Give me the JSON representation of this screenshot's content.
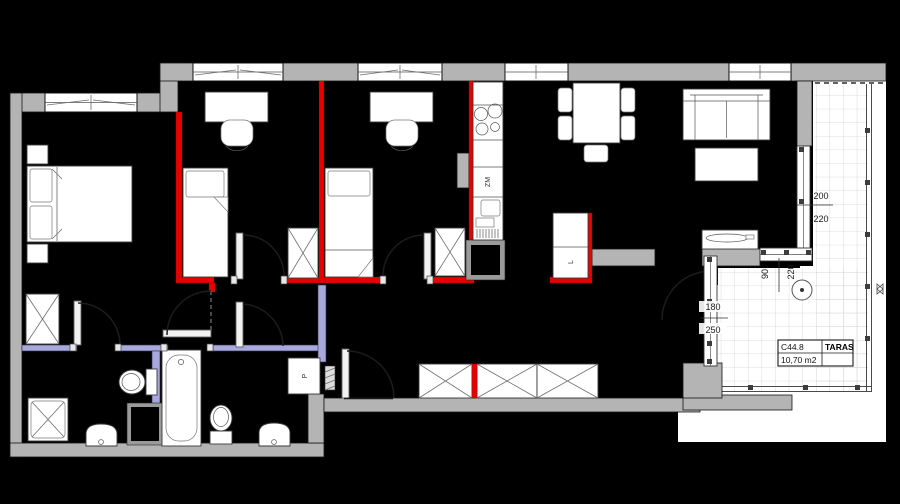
{
  "plan_type": "apartment-floor-plan",
  "colors": {
    "background": "#000000",
    "exterior_wall": "#b4b4b4",
    "partition_wall": "#e60000",
    "plumbing_wall": "#a8a8dc",
    "terrace_tile_line": "#d2d2d2",
    "outdoor": "#ffffff"
  },
  "labels": {
    "dishwasher": "ZM",
    "fridge": "L",
    "washing_machine": "P"
  },
  "terrace_card": {
    "code": "C44.8",
    "name": "TARAS",
    "area": "10,70 m2"
  },
  "dimensions": {
    "east_window_width": "200",
    "east_window_height": "220",
    "south_window_width": "90",
    "south_window_height": "220",
    "terrace_door_width": "180",
    "terrace_door_height": "250"
  }
}
